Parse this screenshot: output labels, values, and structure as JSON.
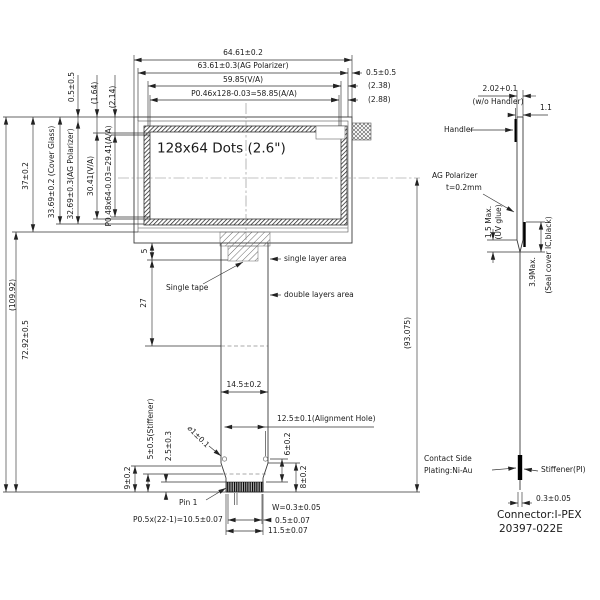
{
  "drawing": {
    "title": "LCD module outline drawing",
    "front": {
      "display_area": "128x64 Dots (2.6\")",
      "total_width": "64.61±0.2",
      "ag_polarizer_width": "63.61±0.3(AG Polarizer)",
      "va_width": "59.85(V/A)",
      "aa_width": "P0.46x128-0.03=58.85(A/A)",
      "right_offset_1": "0.5±0.5",
      "right_offset_2": "(2.38)",
      "right_offset_3": "(2.88)",
      "left_offset_1": "0.5±0.5",
      "left_offset_2": "(1.64)",
      "left_offset_3": "(2.14)",
      "total_height": "(109.92)",
      "tail_height": "72.92±0.5",
      "module_height": "37±0.2",
      "cover_glass_height": "33.69±0.2 (Cover Glass)",
      "ag_polarizer_height": "32.69±0.3(AG Polarizer)",
      "va_height": "30.41(V/A)",
      "aa_height": "P0.48x64-0.03=29.41(A/A)",
      "tape_offset": "5",
      "single_layer_length": "27",
      "single_layer_area": "single layer area",
      "single_tape": "Single tape",
      "double_layers_area": "double layers area",
      "fpc_length": "(93.075)",
      "fpc_width": "14.5±0.2",
      "alignment_hole_pitch": "12.5±0.1(Alignment Hole)",
      "hole_diameter": "⌀1±0.1",
      "dim_6": "6±0.2",
      "dim_8": "8±0.2",
      "dim_9": "9±0.2",
      "stiffener_height": "5±0.5(Stiffener)",
      "contact_height": "2.5±0.3",
      "pin1": "Pin 1",
      "pin_width": "W=0.3±0.05",
      "pin_pitch": "P0.5x(22-1)=10.5±0.07",
      "edge_margin": "0.5±0.07",
      "tail_end_width": "11.5±0.07"
    },
    "side": {
      "thickness": "2.02+0.1",
      "thickness_note": "(w/o Handler)",
      "handler_thickness": "1.1",
      "handler": "Handler",
      "ag_polarizer": "AG Polarizer",
      "ag_thickness": "t=0.2mm",
      "uv_max": "1.5 Max.",
      "uv_glue": "(UV glue)",
      "seal_max": "3.9Max.",
      "seal_cover": "(Seal cover IC,black)",
      "contact_side": "Contact Side",
      "plating": "Plating:Ni-Au",
      "stiffener_pi": "Stiffener(PI)",
      "fpc_thickness": "0.3±0.05",
      "connector": "Connector:I-PEX",
      "connector_pn": "20397-022E"
    }
  }
}
